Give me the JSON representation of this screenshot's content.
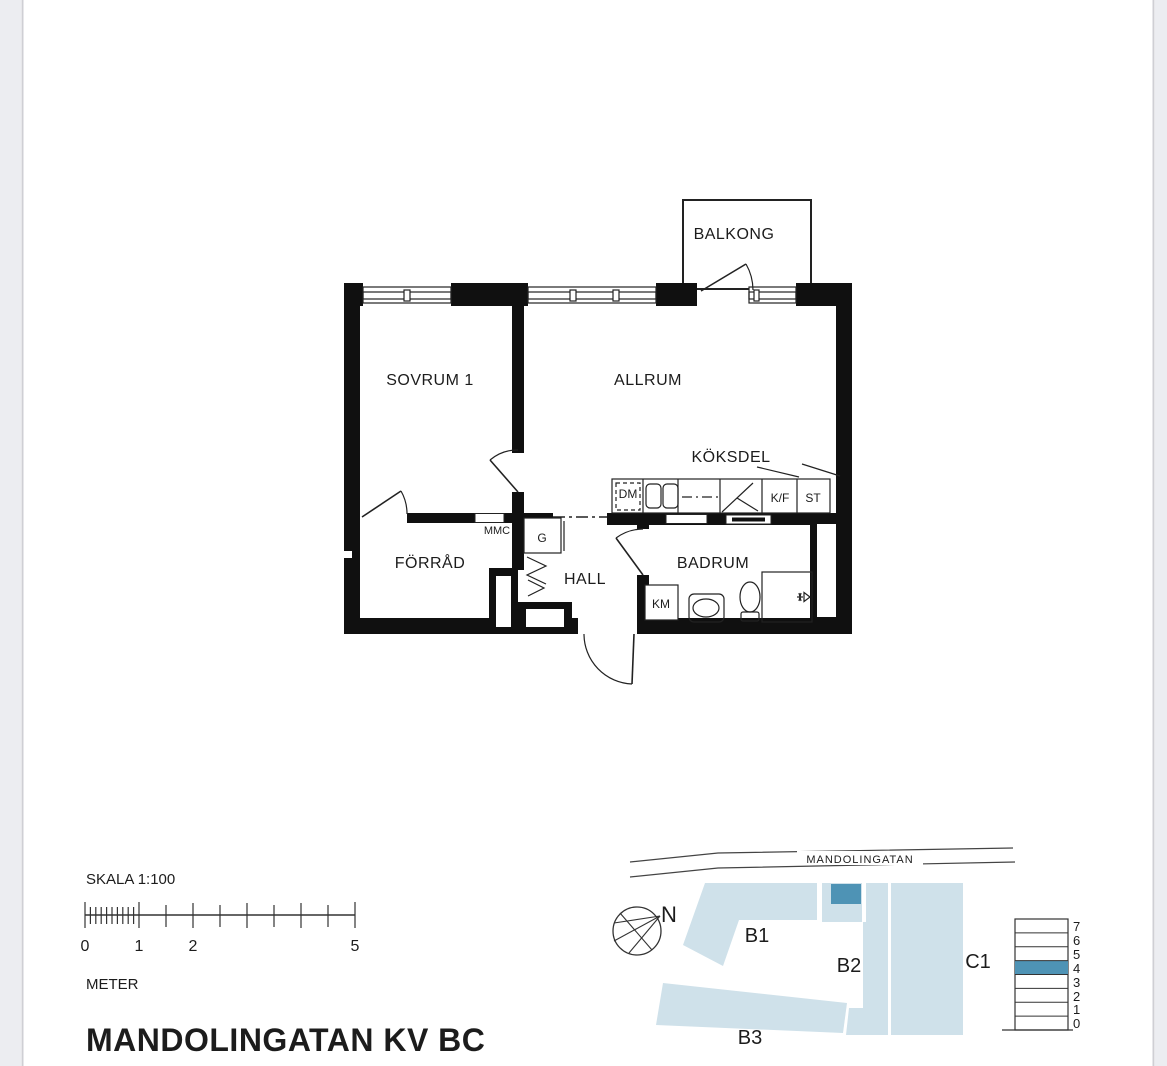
{
  "page": {
    "title": "MANDOLINGATAN KV BC"
  },
  "floor_plan": {
    "rooms": {
      "balcony": "BALKONG",
      "bedroom": "SOVRUM 1",
      "living_room": "ALLRUM",
      "kitchen": "KÖKSDEL",
      "storage": "FÖRRÅD",
      "hall": "HALL",
      "bathroom": "BADRUM"
    },
    "labels": {
      "dishwasher": "DM",
      "fridge_freezer": "K/F",
      "tall_cabinet": "ST",
      "meter_cabinet": "MMC",
      "wardrobe": "G",
      "washing_machine": "KM"
    }
  },
  "scale_bar": {
    "title": "SKALA 1:100",
    "unit": "METER",
    "tick_labels": [
      "0",
      "1",
      "2",
      "5"
    ]
  },
  "site_plan": {
    "street_name": "MANDOLINGATAN",
    "north_label": "N",
    "buildings": [
      {
        "label": "B1"
      },
      {
        "label": "B2"
      },
      {
        "label": "B3"
      },
      {
        "label": "C1"
      }
    ],
    "floor_labels": [
      "7",
      "6",
      "5",
      "4",
      "3",
      "2",
      "1",
      "0"
    ],
    "highlighted_floor": "4",
    "colors": {
      "building_fill": "#cfe1ea",
      "highlight_fill": "#4e93b5"
    }
  }
}
